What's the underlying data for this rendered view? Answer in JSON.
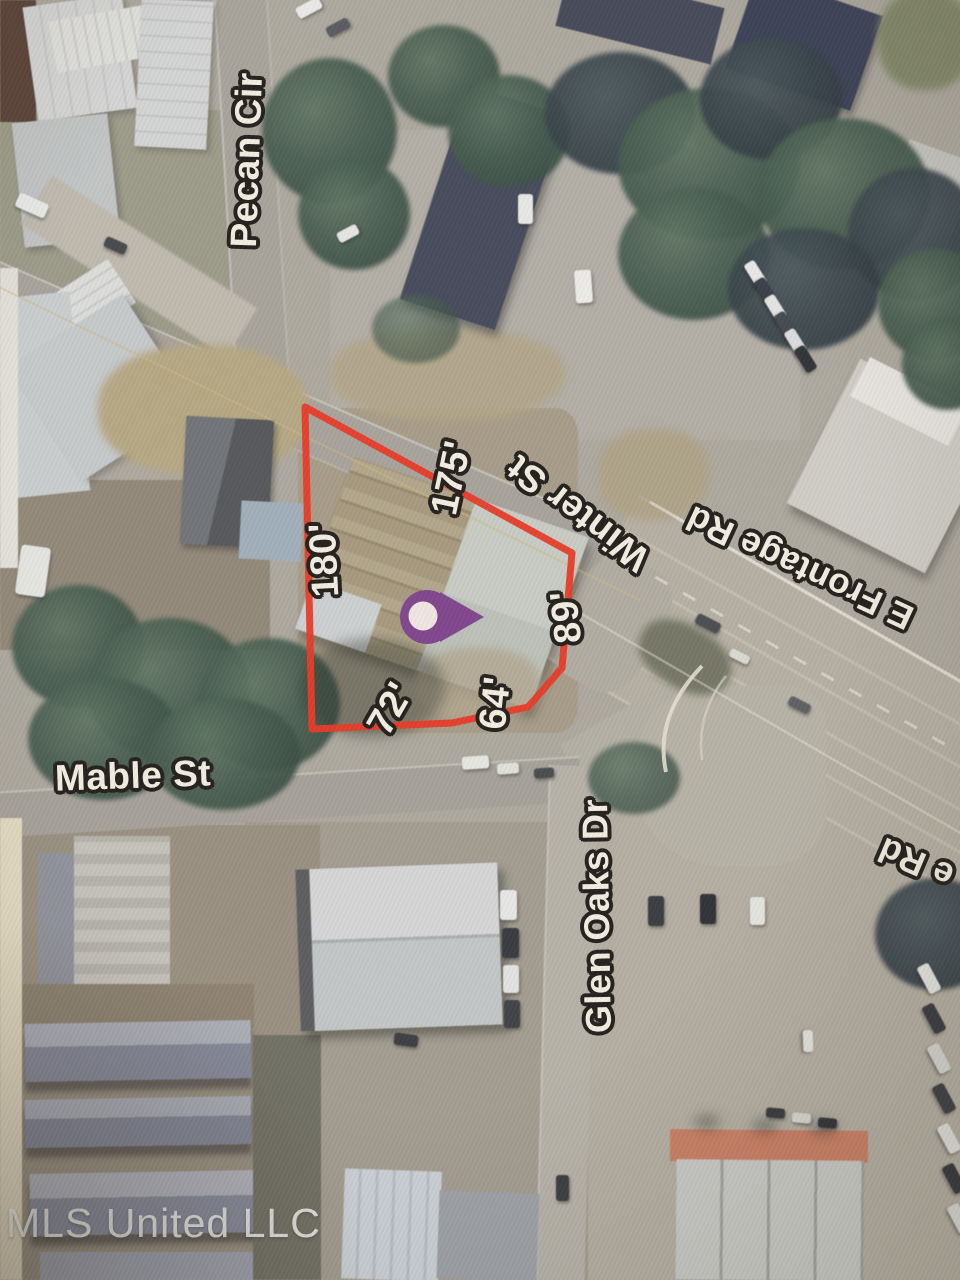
{
  "streets": {
    "pecan_cir": "Pecan Cir",
    "winter_st": "Winter St",
    "frontage_rd": "E Frontage Rd",
    "frontage_rd_partial": "e Rd",
    "mable_st": "Mable St",
    "glen_oaks_dr": "Glen Oaks Dr"
  },
  "parcel": {
    "outline_color": "#e93220",
    "dimensions": {
      "left": "180'",
      "top": "175'",
      "right": "89'",
      "bottom_right": "64'",
      "bottom_left": "72'"
    }
  },
  "pin": {
    "color": "#7c3e8c",
    "inner_color": "#f2e9e7"
  },
  "watermark": "MLS United LLC"
}
